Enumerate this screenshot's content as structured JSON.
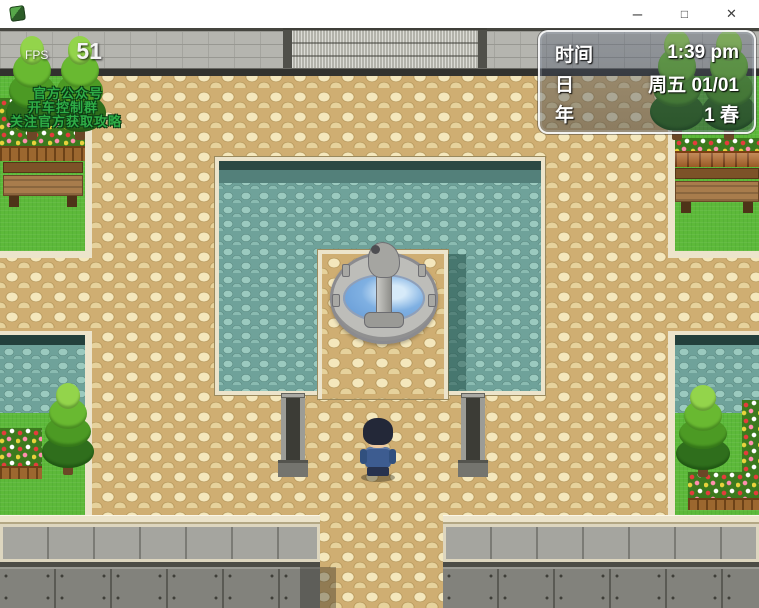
{
  "window": {
    "title": "",
    "controls": [
      {
        "name": "minimize",
        "glyph": "–"
      },
      {
        "name": "maximize",
        "glyph": "□"
      },
      {
        "name": "close",
        "glyph": "✕"
      }
    ]
  },
  "hud": {
    "fps_label": "FPS",
    "fps_value": "51",
    "promo_lines": [
      "官方公众号",
      "开车控制群",
      "关注官方获取攻略"
    ]
  },
  "time_panel": {
    "rows": [
      {
        "label": "时间",
        "value": "1:39 pm"
      },
      {
        "label": "日",
        "value": "周五 01/01"
      },
      {
        "label": "年",
        "value": "1 春"
      }
    ]
  },
  "scene": {
    "objects": [
      "stone-wall",
      "metal-wall-panel",
      "teal-courtyard",
      "fountain",
      "player-character",
      "lamp-post-left",
      "lamp-post-right",
      "pine-trees",
      "benches",
      "flower-beds",
      "bottom-wall"
    ]
  },
  "colors": {
    "plaza_tan": "#cfae72",
    "courtyard_teal": "#6fa29a",
    "grass_green": "#5db93a",
    "water_blue": "#7fb0e2",
    "trim_cream": "#ece4cb",
    "wall_gray": "#b5b5af",
    "promo_green": "#2fae47",
    "titlebar_white": "#ffffff"
  }
}
